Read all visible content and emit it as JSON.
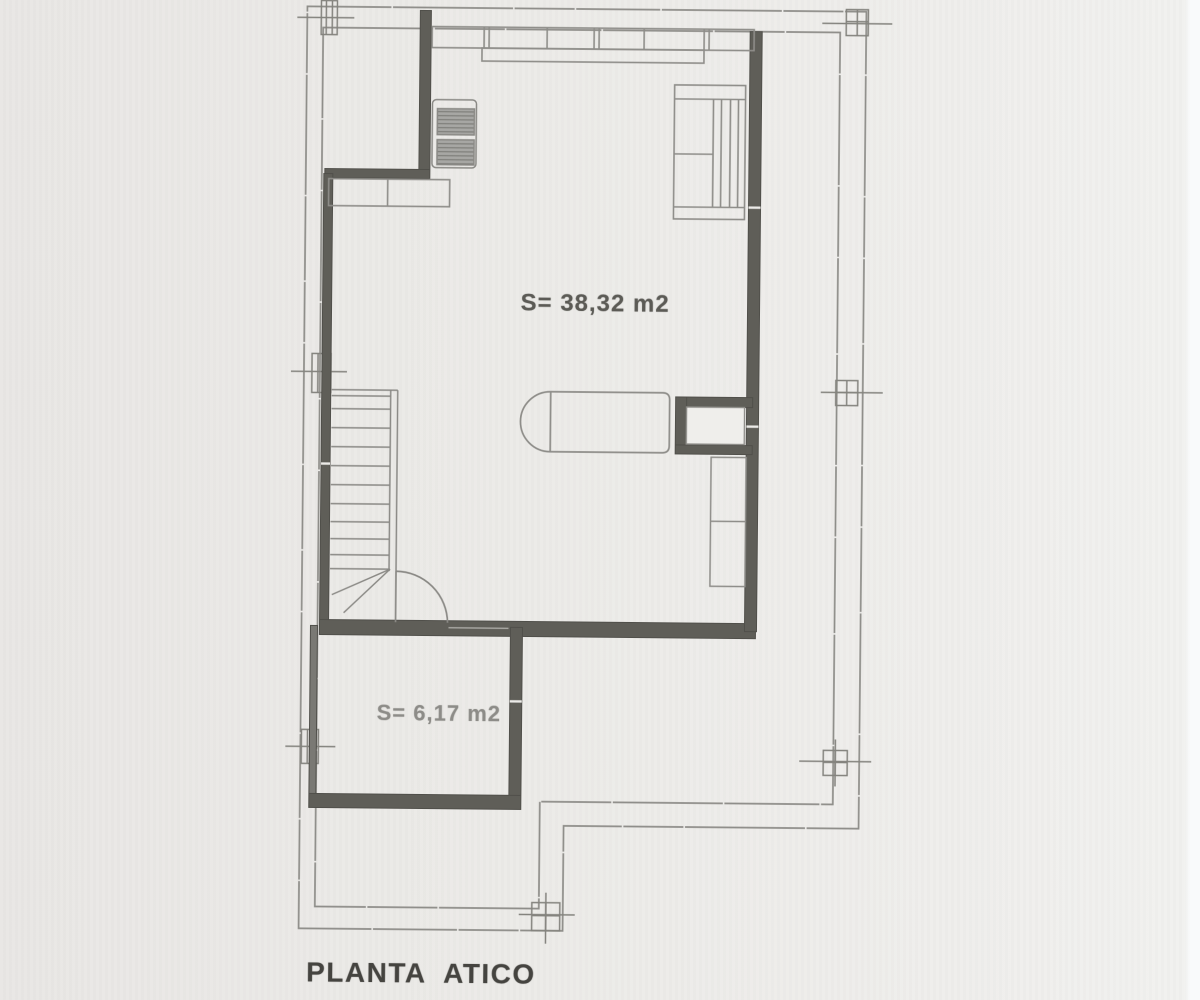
{
  "document": {
    "type": "architectural floor plan scan",
    "title": "PLANTA  ATICO",
    "rooms": [
      {
        "id": "main-room",
        "area_label": "S= 38,32 m2"
      },
      {
        "id": "lower-room",
        "area_label": "S= 6,17 m2"
      }
    ],
    "colors": {
      "paper": "#ece9e7",
      "thin_line": "#8e8d89",
      "wall": "#5f5e58",
      "title_text": "#454440",
      "main_label_text": "#5c5b56",
      "faded_label_text": "#8d8c88"
    }
  }
}
